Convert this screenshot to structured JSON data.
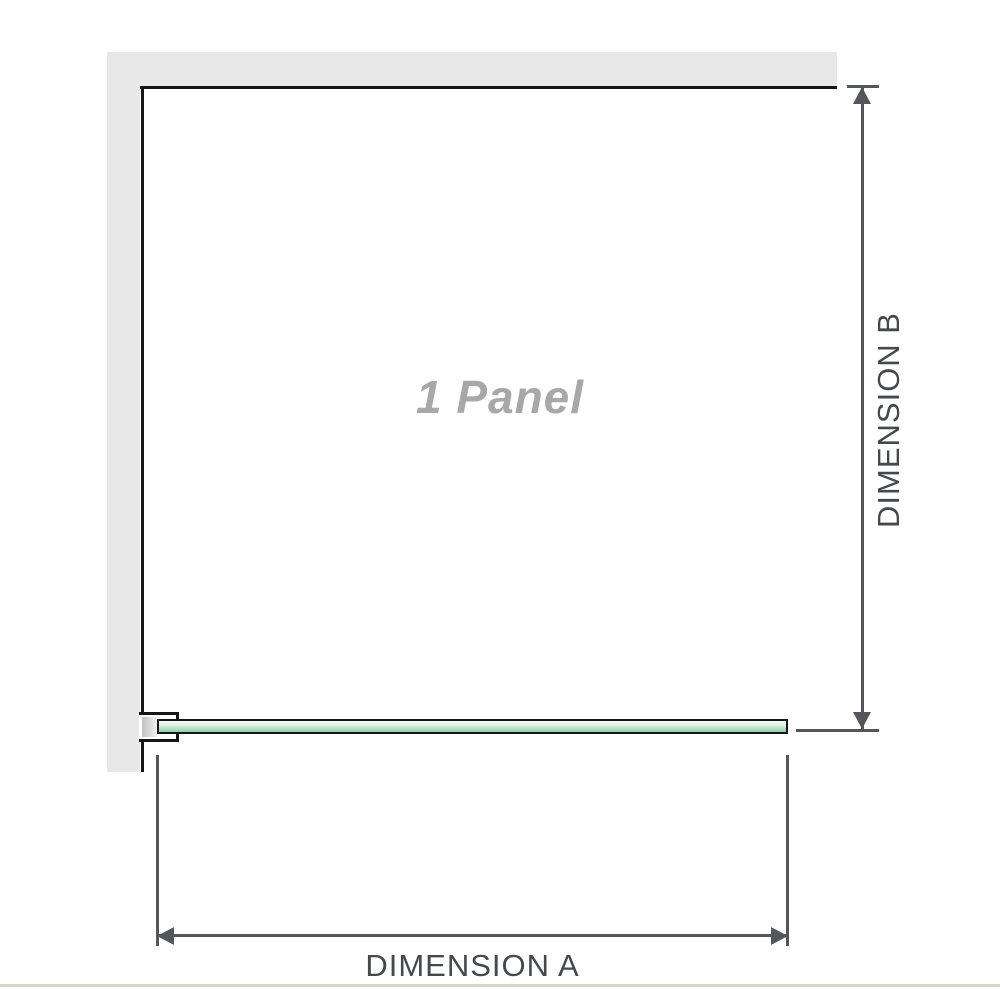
{
  "diagram": {
    "panel_label": "1 Panel",
    "dimension_a": {
      "label": "DIMENSION A"
    },
    "dimension_b": {
      "label": "DIMENSION B"
    }
  },
  "icons": {
    "dimension_b_top": "arrow-up-icon",
    "dimension_b_bottom": "arrow-down-icon",
    "dimension_a_left": "arrow-left-icon",
    "dimension_a_right": "arrow-right-icon"
  },
  "colors": {
    "background": "#ffffff",
    "wall_fill": "#e8e8e8",
    "panel_outline": "#161616",
    "glass_gradient_top": "#f3faf6",
    "glass_gradient_bottom": "#8fcfa4",
    "glass_border": "#161616",
    "bracket_pad_fill": "#c2c2c2",
    "dimension_line": "#53565a",
    "dimension_text": "#45494e",
    "panel_label_text": "#a8a8a8",
    "bottom_divider": "#d9d4c6"
  }
}
